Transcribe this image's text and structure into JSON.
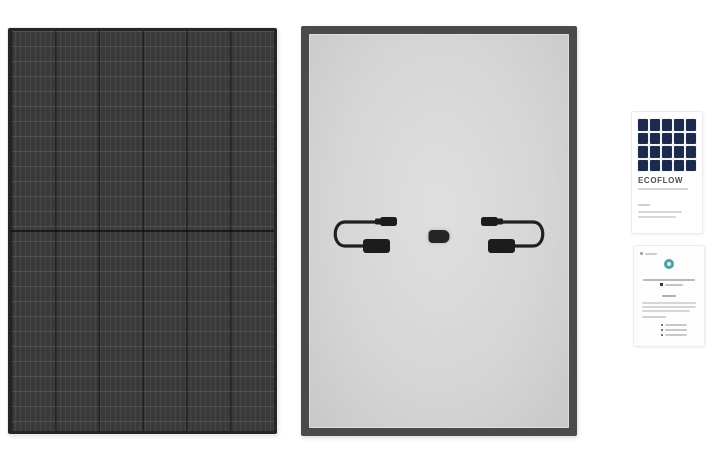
{
  "page": {
    "background_color": "#ffffff",
    "description": "Product image montage of a rigid solar panel: front view, back view, brand label card and manual card"
  },
  "gallery": {
    "front_panel": {
      "label": "all-black solar panel, front view",
      "body_color": "#3a3a3a",
      "frame_color": "#262626",
      "cell_columns": 6,
      "half_cut_divider": true
    },
    "back_panel": {
      "label": "solar panel, back view",
      "frame_color": "#4a4a4a",
      "backsheet_color": "#d6d6d6",
      "junction_box_color": "#262626",
      "cable_color": "#202020",
      "cable_count": 2,
      "connector_type": "MC4"
    },
    "label_card": {
      "brand": "ECOFLOW",
      "brand_color": "#4f4f4f",
      "thumbnail_cell_color": "#1c2b4d",
      "thumbnail_grid": "5x4"
    },
    "manual_card": {
      "label": "user manual / warranty card",
      "icon_color": "#4aa2a1",
      "list_item_count": 3
    }
  }
}
